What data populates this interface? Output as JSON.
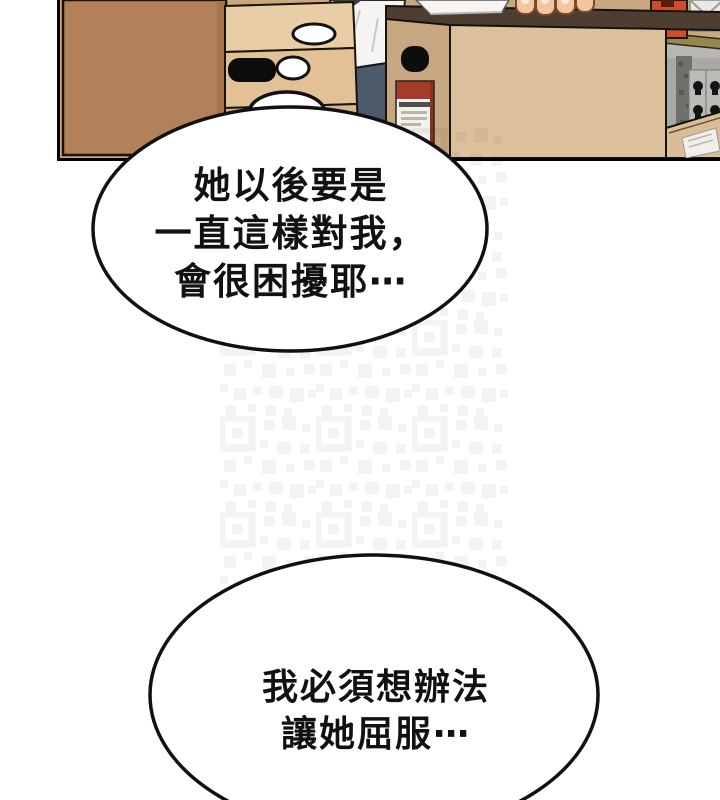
{
  "bubbles": [
    {
      "lines": [
        "她以後要是",
        "一直這樣對我，",
        "會很困擾耶⋯"
      ]
    },
    {
      "lines": [
        "我必須想辦法",
        "讓她屈服⋯"
      ]
    }
  ],
  "panel": {
    "colors": {
      "wall": "#c9a87f",
      "dark_box": "#b28059",
      "light_box_top": "#e8cda6",
      "light_box_bottom": "#e2c197",
      "big_box_front": "#dcc09c",
      "big_box_side": "#c7a781",
      "box_opening": "#4e3e31",
      "label_red": "#a63b2b",
      "orange_box": "#cf4e28",
      "pants": "#4c5a6b",
      "shirt": "#f5f4f2",
      "skin": "#f2c79f",
      "shelf_gray": "#a9a8a4",
      "wood_edge": "#97874d"
    }
  }
}
